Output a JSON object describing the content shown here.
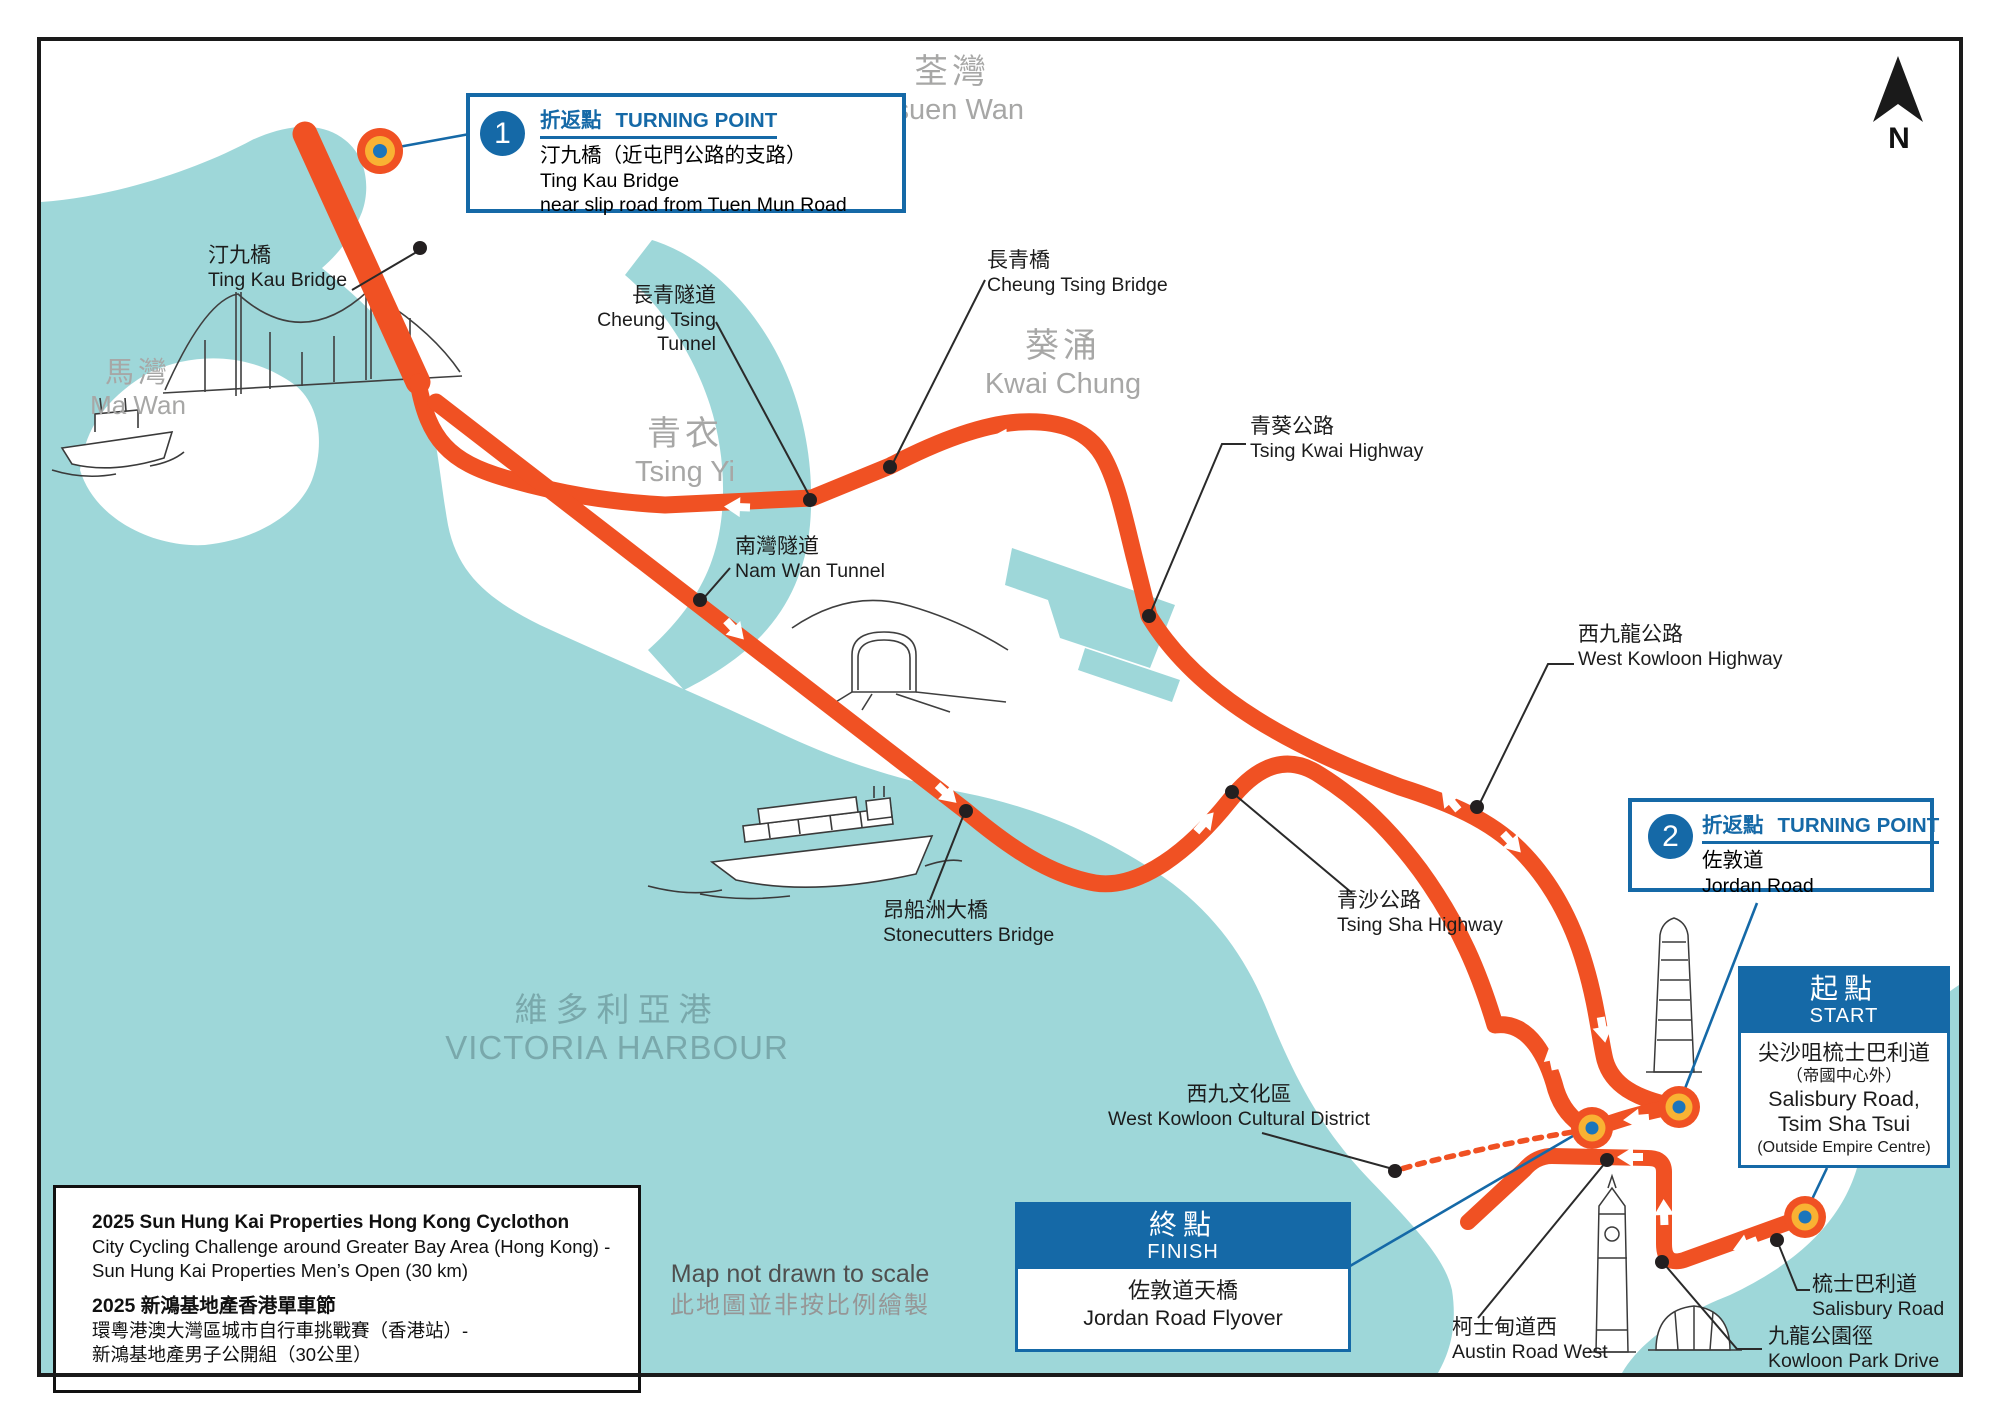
{
  "map": {
    "compass_n": "N",
    "scale_note_en": "Map not drawn to scale",
    "scale_note_zh": "此地圖並非按比例繪製"
  },
  "colors": {
    "water": "#9ed7d9",
    "route_orange": "#f05123",
    "marker_gold": "#f9b233",
    "accent_blue": "#1569a7",
    "place_gray": "#a7a7a6"
  },
  "boxes": {
    "turning_point_1": {
      "number": "1",
      "label_zh": "折返點",
      "label_en": "TURNING POINT",
      "line1": "汀九橋（近屯門公路的支路）",
      "line2": "Ting Kau Bridge",
      "line3": "near slip road from Tuen Mun Road"
    },
    "turning_point_2": {
      "number": "2",
      "label_zh": "折返點",
      "label_en": "TURNING POINT",
      "line1": "佐敦道",
      "line2": "Jordan Road"
    },
    "start": {
      "title_zh": "起點",
      "title_en": "START",
      "line1": "尖沙咀梳士巴利道",
      "line2": "（帝國中心外）",
      "line3": "Salisbury Road,",
      "line4": "Tsim Sha Tsui",
      "line5": "(Outside Empire Centre)"
    },
    "finish": {
      "title_zh": "終點",
      "title_en": "FINISH",
      "line1": "佐敦道天橋",
      "line2": "Jordan Road Flyover"
    },
    "info": {
      "en_title": "2025 Sun Hung Kai Properties Hong Kong Cyclothon",
      "en_line2": "City Cycling Challenge around Greater Bay Area (Hong Kong) -",
      "en_line3": "Sun Hung Kai Properties Men’s Open (30 km)",
      "zh_title": "2025 新鴻基地產香港單車節",
      "zh_line2": "環粵港澳大灣區城市自行車挑戰賽（香港站）-",
      "zh_line3": "新鴻基地產男子公開組（30公里）"
    }
  },
  "labels": {
    "ting_kau_bridge": {
      "zh": "汀九橋",
      "en": "Ting Kau Bridge"
    },
    "cheung_tsing_tunnel": {
      "zh": "長青隧道",
      "en": "Cheung Tsing\nTunnel"
    },
    "cheung_tsing_bridge": {
      "zh": "長青橋",
      "en": "Cheung Tsing Bridge"
    },
    "nam_wan_tunnel": {
      "zh": "南灣隧道",
      "en": "Nam Wan Tunnel"
    },
    "tsing_kwai_highway": {
      "zh": "青葵公路",
      "en": "Tsing Kwai Highway"
    },
    "west_kowloon_highway": {
      "zh": "西九龍公路",
      "en": "West Kowloon Highway"
    },
    "tsing_sha_highway": {
      "zh": "青沙公路",
      "en": "Tsing Sha Highway"
    },
    "stonecutters_bridge": {
      "zh": "昂船洲大橋",
      "en": "Stonecutters Bridge"
    },
    "west_kowloon_cultural_district": {
      "zh": "西九文化區",
      "en": "West Kowloon Cultural District"
    },
    "austin_road_west": {
      "zh": "柯士甸道西",
      "en": "Austin Road West"
    },
    "salisbury_road": {
      "zh": "梳士巴利道",
      "en": "Salisbury Road"
    },
    "kowloon_park_drive": {
      "zh": "九龍公園徑",
      "en": "Kowloon Park Drive"
    }
  },
  "places": {
    "tsuen_wan": {
      "zh": "荃灣",
      "en": "Tsuen Wan"
    },
    "kwai_chung": {
      "zh": "葵涌",
      "en": "Kwai  Chung"
    },
    "tsing_yi": {
      "zh": "青衣",
      "en": "Tsing Yi"
    },
    "ma_wan": {
      "zh": "馬灣",
      "en": "Ma Wan"
    },
    "victoria_harbour": {
      "zh": "維多利亞港",
      "en": "VICTORIA HARBOUR"
    }
  }
}
